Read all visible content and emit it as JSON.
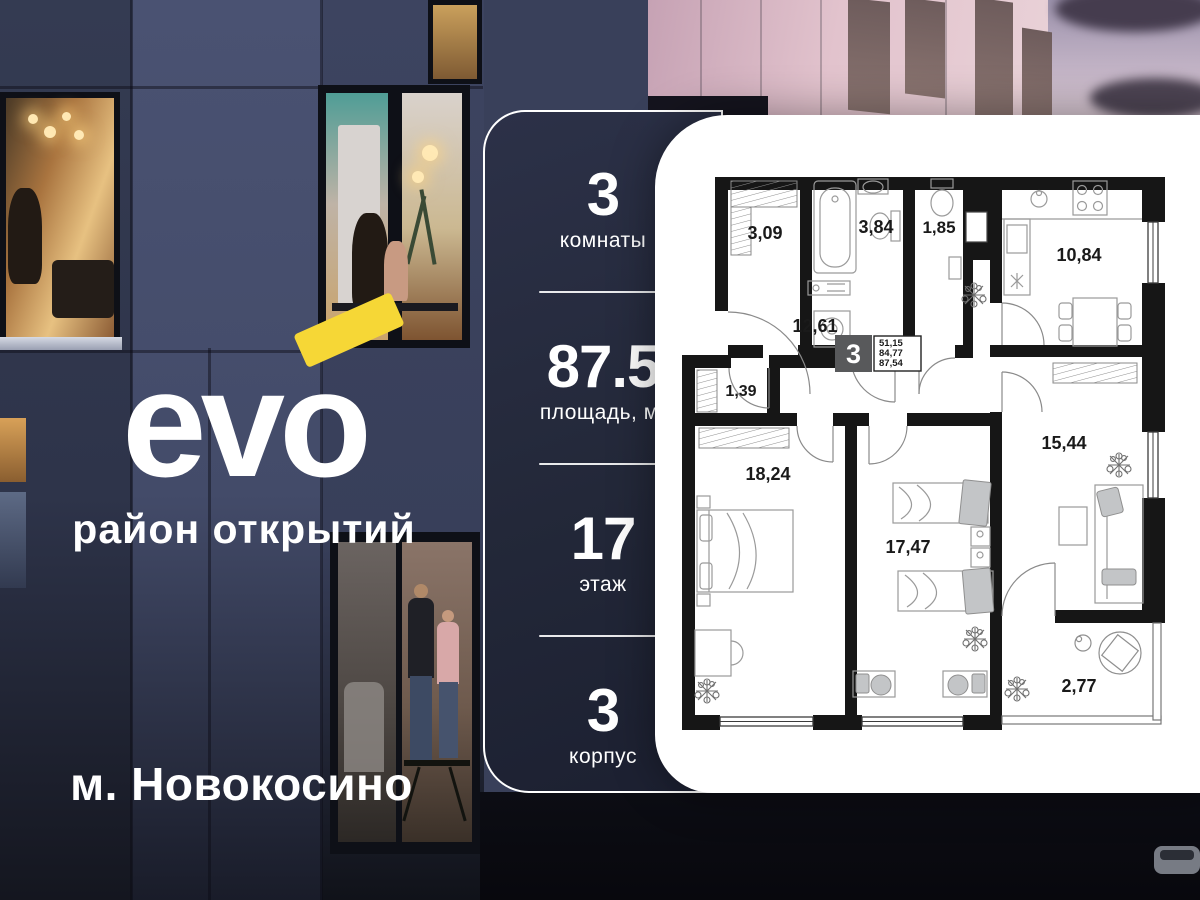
{
  "brand": {
    "logo": "evo",
    "tagline": "район открытий",
    "metro": "м. Новокосино",
    "accent_yellow": "#f6d736"
  },
  "specs": [
    {
      "value": "3",
      "label": "комнаты"
    },
    {
      "value": "87.5",
      "label": "площадь, м²"
    },
    {
      "value": "17",
      "label": "этаж"
    },
    {
      "value": "3",
      "label": "корпус"
    }
  ],
  "floorplan": {
    "badge_rooms": "3",
    "summary": [
      "51,15",
      "84,77",
      "87,54"
    ],
    "rooms": {
      "wardrobe": "3,09",
      "bathroom": "3,84",
      "wc": "1,85",
      "kitchen": "10,84",
      "hallway": "12,61",
      "closet": "1,39",
      "bedroom": "18,24",
      "kids_room": "17,47",
      "living_room": "15,44",
      "balcony": "2,77"
    }
  }
}
